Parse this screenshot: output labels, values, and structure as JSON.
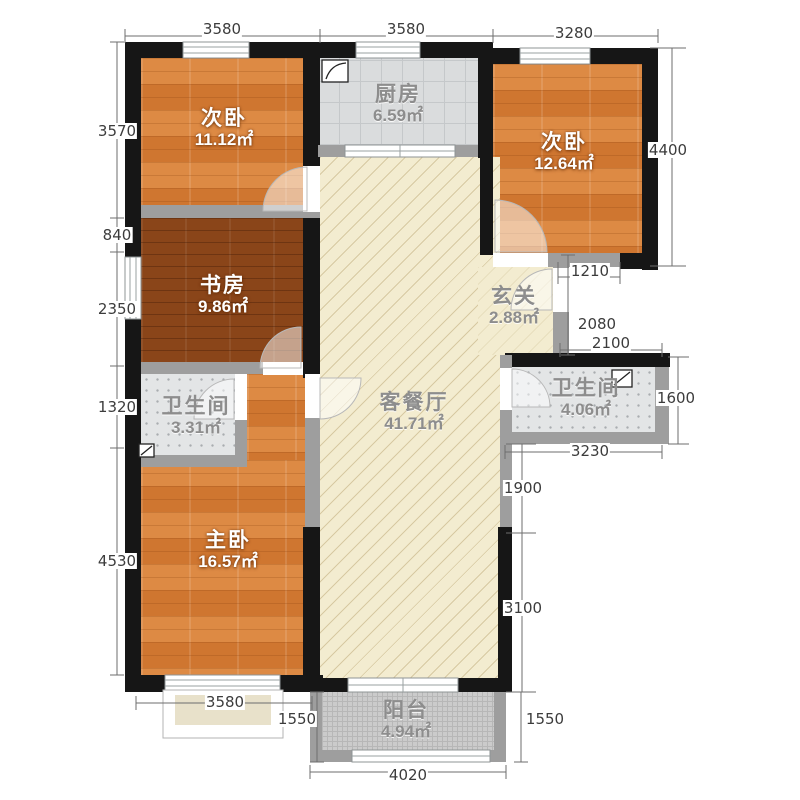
{
  "title": "三室两厅户型图",
  "unit": "mm",
  "rooms": [
    {
      "id": "bedroom-top-left",
      "name": "次卧",
      "area": "11.12㎡",
      "floor": "wood"
    },
    {
      "id": "kitchen",
      "name": "厨房",
      "area": "6.59㎡",
      "floor": "tile-grid"
    },
    {
      "id": "bedroom-top-right",
      "name": "次卧",
      "area": "12.64㎡",
      "floor": "wood"
    },
    {
      "id": "study",
      "name": "书房",
      "area": "9.86㎡",
      "floor": "dark-wood"
    },
    {
      "id": "hall",
      "name": "玄关",
      "area": "2.88㎡",
      "floor": "cream"
    },
    {
      "id": "bath-left",
      "name": "卫生间",
      "area": "3.31㎡",
      "floor": "tile-dots"
    },
    {
      "id": "living-dining",
      "name": "客餐厅",
      "area": "41.71㎡",
      "floor": "hatch"
    },
    {
      "id": "bath-right",
      "name": "卫生间",
      "area": "4.06㎡",
      "floor": "tile-dots"
    },
    {
      "id": "master-bedroom",
      "name": "主卧",
      "area": "16.57㎡",
      "floor": "wood"
    },
    {
      "id": "balcony",
      "name": "阳台",
      "area": "4.94㎡",
      "floor": "grid"
    }
  ],
  "dims": [
    "3580",
    "3580",
    "3280",
    "3570",
    "840",
    "2350",
    "1320",
    "4530",
    "4400",
    "1210",
    "2080",
    "2100",
    "1600",
    "3230",
    "1900",
    "3100",
    "1550",
    "3580",
    "4020",
    "1550"
  ],
  "colors": {
    "wall_black": "#161616",
    "wall_gray": "#9e9e9e",
    "wood_floor": "#d6803a",
    "dark_wood_floor": "#8a4519",
    "tile": "#dadcdd",
    "living_floor": "#f3ecd0",
    "balcony_floor": "#cbcbcb",
    "dim_text": "#3c3c3c"
  }
}
